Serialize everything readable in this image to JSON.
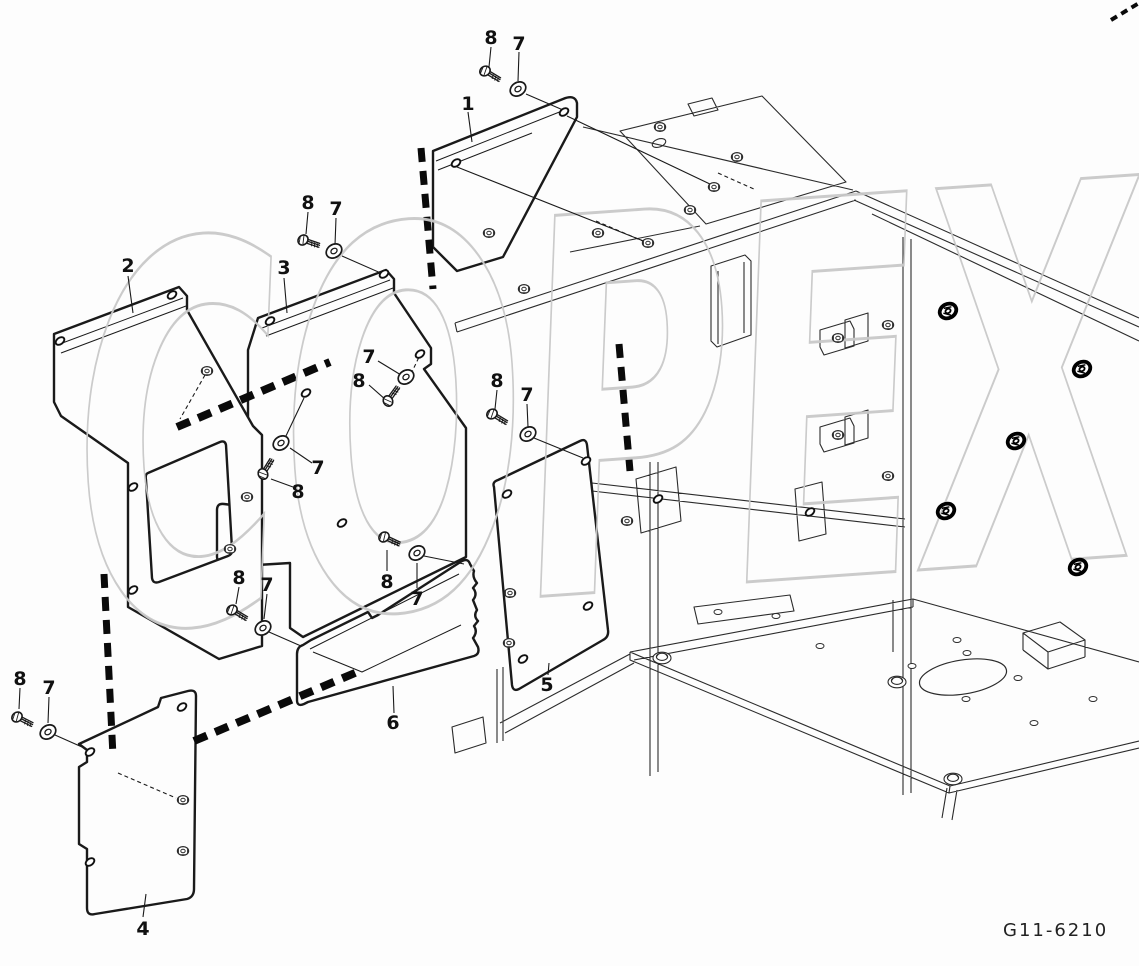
{
  "diagram": {
    "title_code": "G11-6210",
    "watermark_text": "COPEX",
    "colors": {
      "background": "#fdfdfd",
      "line": "#1a1a1a",
      "thin_line": "#2b2b2b",
      "watermark": "#c9c9c9"
    },
    "callout_labels": {
      "part_1": "1",
      "part_2": "2",
      "part_3": "3",
      "part_4": "4",
      "part_5": "5",
      "part_6": "6",
      "bolt": "8",
      "washer": "7"
    }
  }
}
